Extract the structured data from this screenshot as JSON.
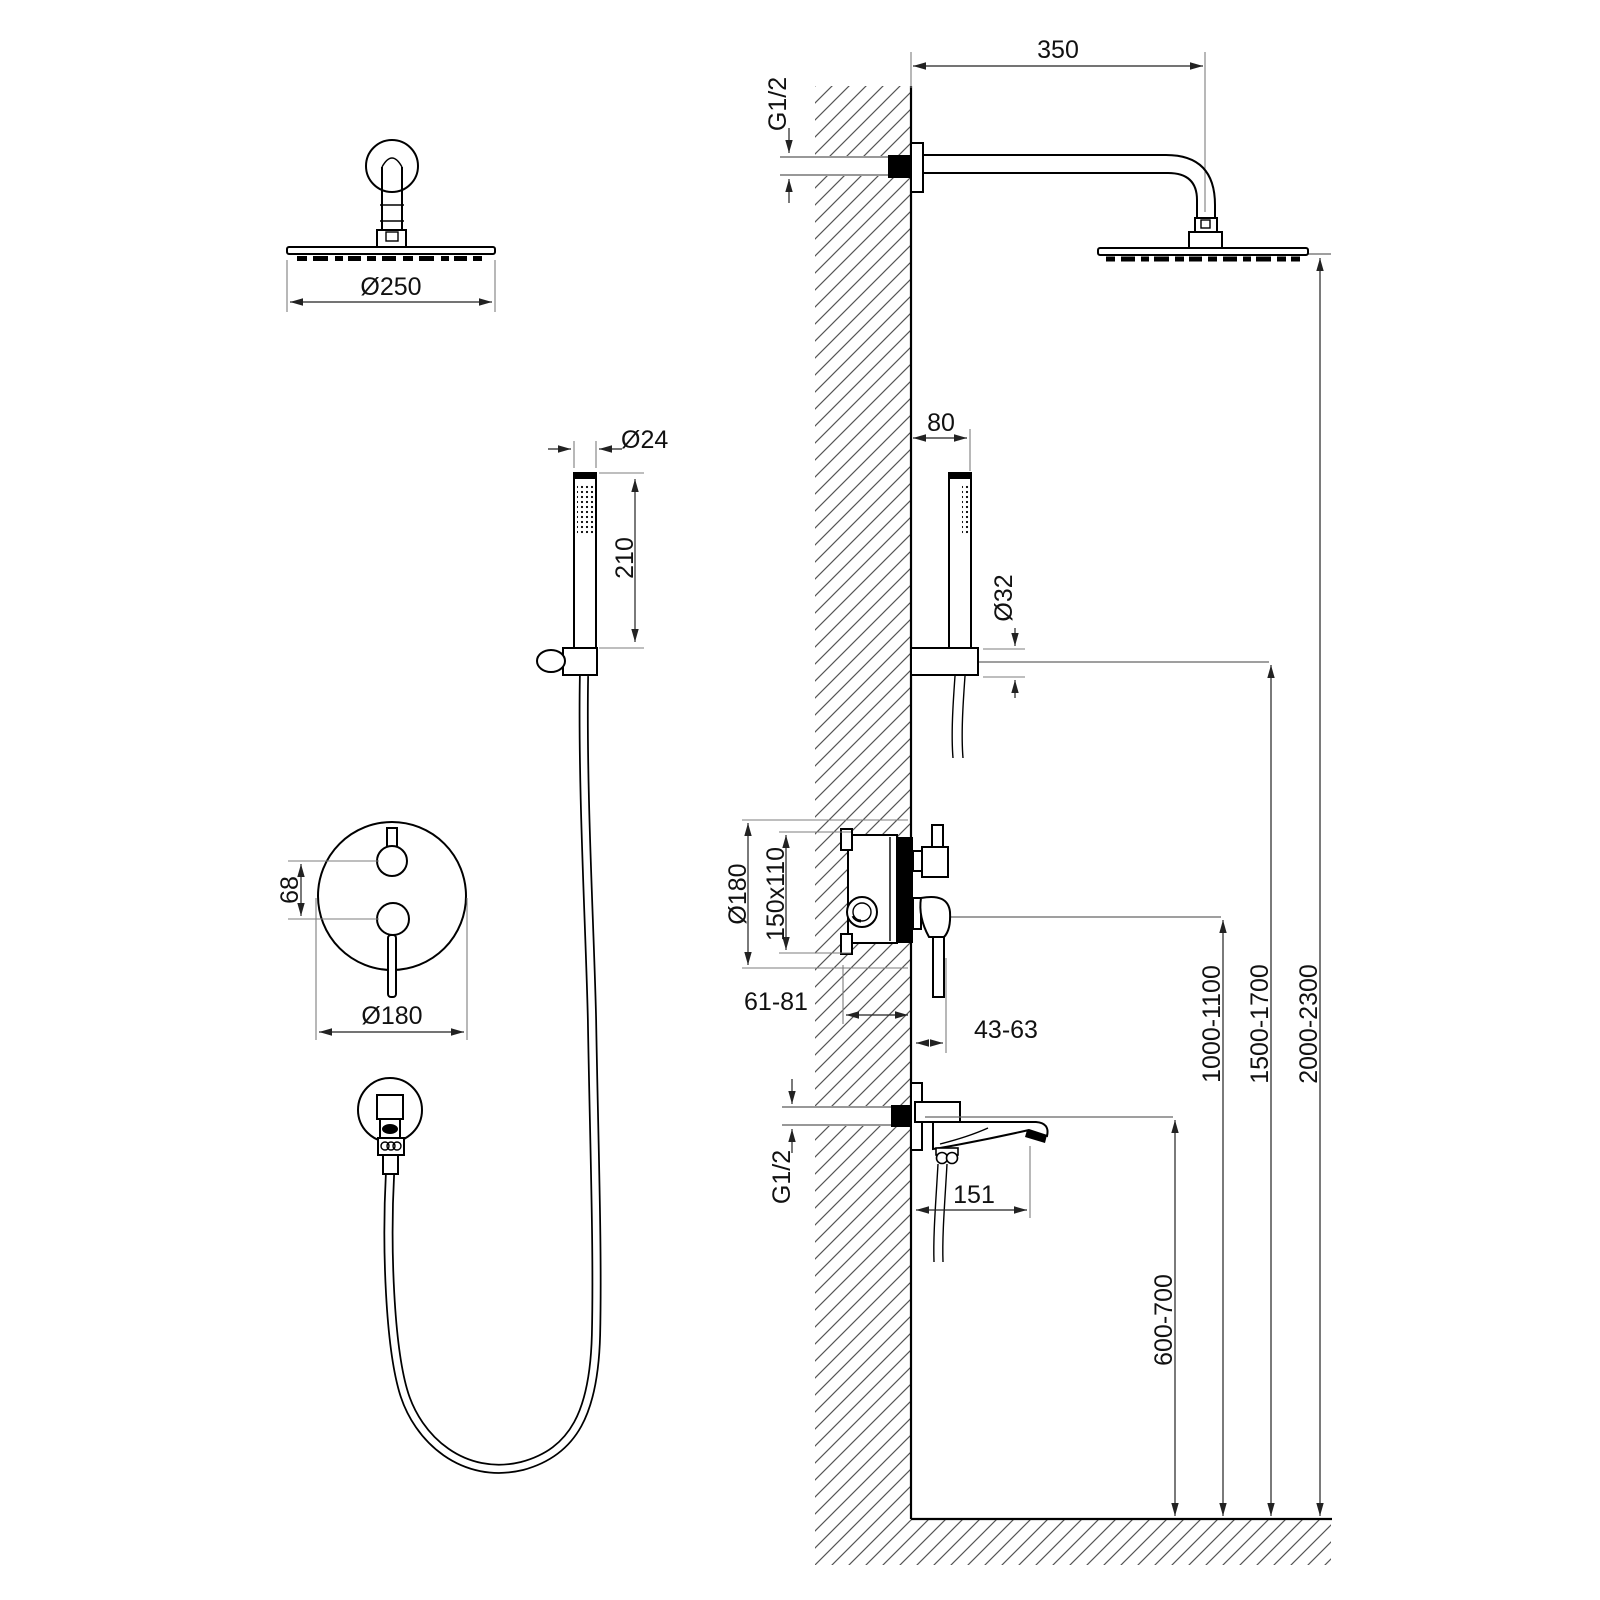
{
  "drawing": {
    "kind": "concealed shower system installation diagram",
    "line_color": "#000000",
    "background": "#ffffff"
  },
  "views": {
    "head_front": {
      "diameter": "Ø250"
    },
    "hand_shower_front": {
      "diameter": "Ø24",
      "length": "210"
    },
    "valve_trim_front": {
      "handle_spacing": "68",
      "plate_diameter": "Ø180"
    },
    "installation": {
      "arm_projection": "350",
      "arm_thread": "G1/2",
      "hand_shower_offset": "80",
      "holder_diameter": "Ø32",
      "valve_plate_diameter": "Ø180",
      "valve_box_size": "150x110",
      "valve_recess_depth": "61-81",
      "trim_projection": "43-63",
      "valve_height_range": "1000-1100",
      "holder_height_range": "1500-1700",
      "head_height_range": "2000-2300",
      "spout_thread": "G1/2",
      "spout_projection": "151",
      "spout_height_range": "600-700"
    }
  }
}
